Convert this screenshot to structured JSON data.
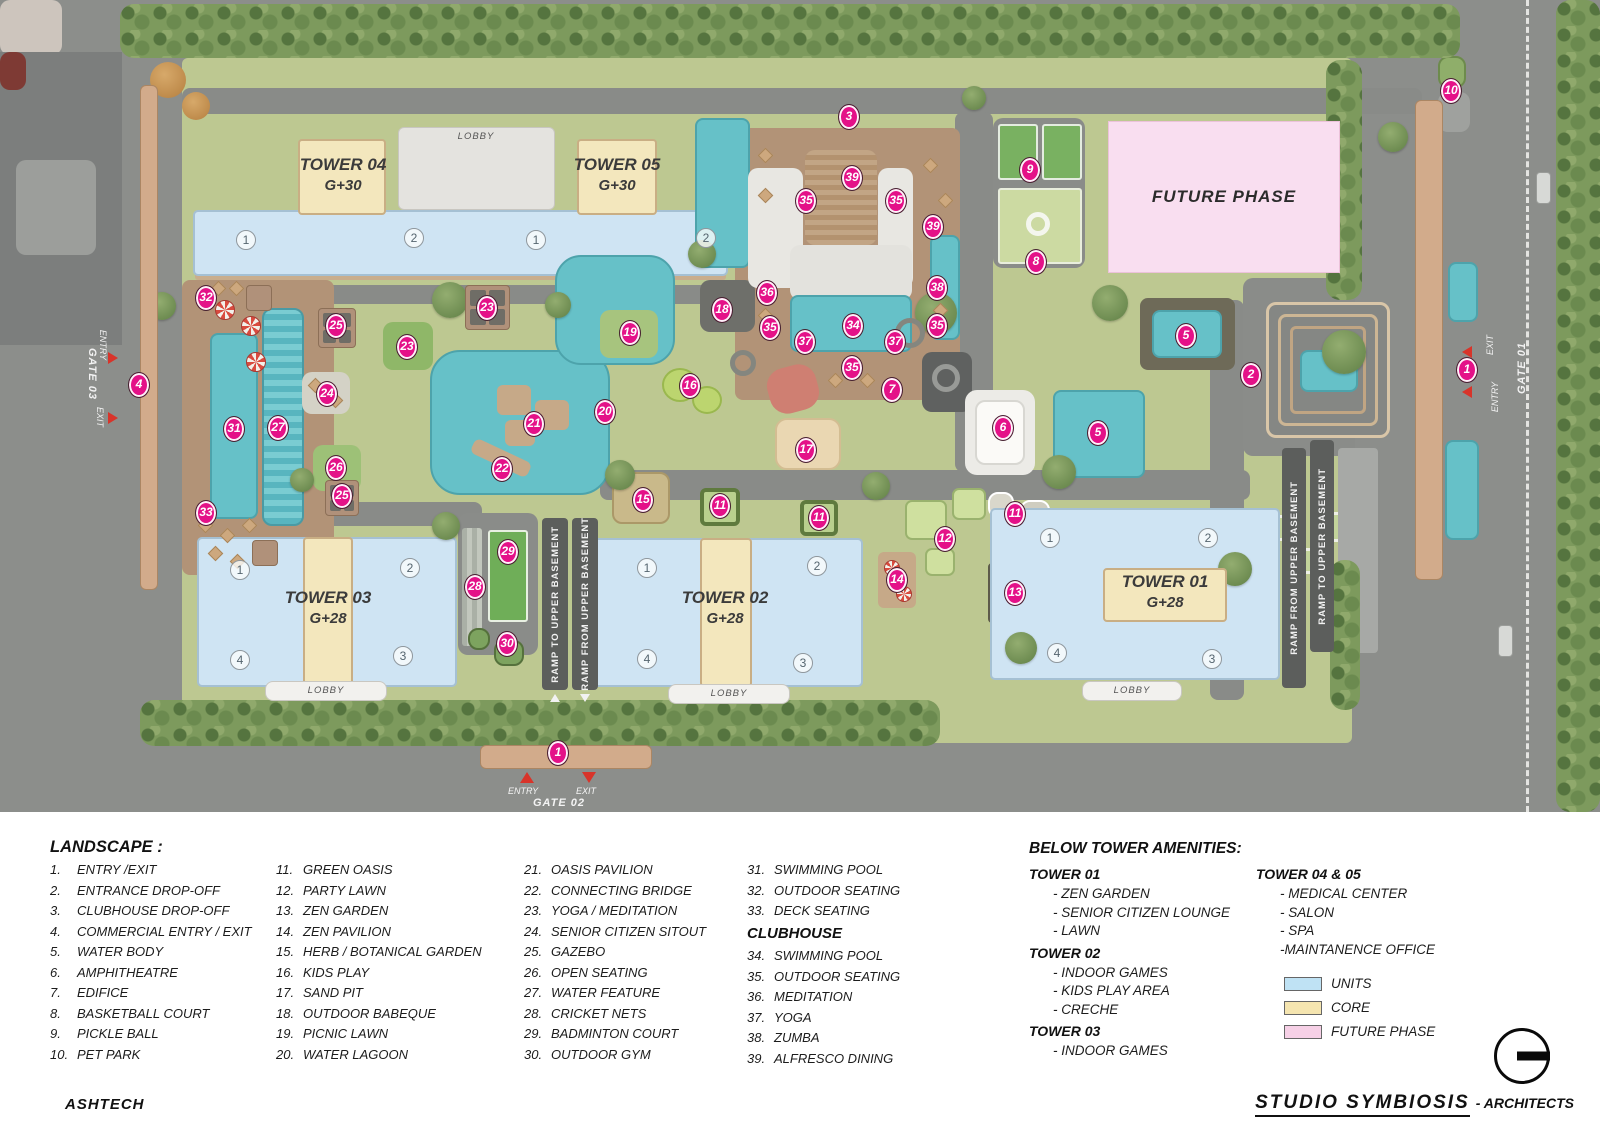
{
  "map": {
    "towers": {
      "t04": {
        "name": "TOWER 04",
        "floors": "G+30"
      },
      "t05": {
        "name": "TOWER 05",
        "floors": "G+30"
      },
      "t03": {
        "name": "TOWER 03",
        "floors": "G+28"
      },
      "t02": {
        "name": "TOWER 02",
        "floors": "G+28"
      },
      "t01": {
        "name": "TOWER 01",
        "floors": "G+28"
      }
    },
    "labels": {
      "lobby": "LOBBY",
      "future_phase": "FUTURE PHASE",
      "gate01": "GATE 01",
      "gate02": "GATE 02",
      "gate03": "GATE 03",
      "entry": "ENTRY",
      "exit": "EXIT",
      "ramp_to": "RAMP TO UPPER BASEMENT",
      "ramp_from": "RAMP FROM UPPER BASEMENT"
    },
    "markers": [
      [
        3,
        849,
        117
      ],
      [
        39,
        852,
        178
      ],
      [
        35,
        806,
        201
      ],
      [
        35,
        896,
        201
      ],
      [
        39,
        933,
        227
      ],
      [
        9,
        1030,
        170
      ],
      [
        8,
        1036,
        262
      ],
      [
        10,
        1451,
        91
      ],
      [
        36,
        767,
        293
      ],
      [
        38,
        937,
        288
      ],
      [
        18,
        722,
        310
      ],
      [
        19,
        630,
        333
      ],
      [
        23,
        487,
        308
      ],
      [
        23,
        407,
        347
      ],
      [
        25,
        336,
        326
      ],
      [
        32,
        206,
        298
      ],
      [
        34,
        853,
        326
      ],
      [
        35,
        770,
        328
      ],
      [
        35,
        937,
        326
      ],
      [
        37,
        805,
        342
      ],
      [
        37,
        895,
        342
      ],
      [
        35,
        852,
        368
      ],
      [
        5,
        1186,
        336
      ],
      [
        2,
        1251,
        375
      ],
      [
        16,
        690,
        386
      ],
      [
        24,
        327,
        394
      ],
      [
        31,
        234,
        429
      ],
      [
        27,
        278,
        428
      ],
      [
        21,
        534,
        424
      ],
      [
        20,
        605,
        412
      ],
      [
        7,
        892,
        390
      ],
      [
        6,
        1003,
        428
      ],
      [
        5,
        1098,
        433
      ],
      [
        17,
        806,
        450
      ],
      [
        26,
        336,
        468
      ],
      [
        22,
        502,
        469
      ],
      [
        15,
        643,
        500
      ],
      [
        11,
        720,
        506
      ],
      [
        11,
        819,
        518
      ],
      [
        11,
        1015,
        514
      ],
      [
        25,
        342,
        496
      ],
      [
        33,
        206,
        513
      ],
      [
        12,
        945,
        539
      ],
      [
        29,
        508,
        552
      ],
      [
        28,
        475,
        587
      ],
      [
        14,
        897,
        580
      ],
      [
        13,
        1015,
        593
      ],
      [
        30,
        507,
        644
      ],
      [
        1,
        558,
        753
      ],
      [
        1,
        1467,
        370
      ],
      [
        4,
        139,
        385
      ]
    ],
    "unit_numbers": [
      [
        1,
        246,
        240
      ],
      [
        2,
        414,
        238
      ],
      [
        1,
        536,
        240
      ],
      [
        2,
        706,
        238
      ],
      [
        1,
        240,
        570
      ],
      [
        2,
        410,
        568
      ],
      [
        4,
        240,
        660
      ],
      [
        3,
        403,
        656
      ],
      [
        1,
        647,
        568
      ],
      [
        2,
        817,
        566
      ],
      [
        4,
        647,
        659
      ],
      [
        3,
        803,
        663
      ],
      [
        1,
        1050,
        538
      ],
      [
        2,
        1208,
        538
      ],
      [
        4,
        1057,
        653
      ],
      [
        3,
        1212,
        659
      ]
    ]
  },
  "legend": {
    "landscape_title": "LANDSCAPE :",
    "landscape_items": [
      "ENTRY /EXIT",
      "ENTRANCE DROP-OFF",
      "CLUBHOUSE DROP-OFF",
      "COMMERCIAL ENTRY / EXIT",
      "WATER BODY",
      "AMPHITHEATRE",
      "EDIFICE",
      "BASKETBALL COURT",
      "PICKLE BALL",
      "PET PARK",
      "GREEN OASIS",
      "PARTY LAWN",
      "ZEN GARDEN",
      "ZEN PAVILION",
      "HERB / BOTANICAL GARDEN",
      "KIDS PLAY",
      "SAND PIT",
      "OUTDOOR BABEQUE",
      "PICNIC LAWN",
      "WATER LAGOON",
      "OASIS PAVILION",
      "CONNECTING BRIDGE",
      "YOGA / MEDITATION",
      "SENIOR CITIZEN SITOUT",
      "GAZEBO",
      "OPEN SEATING",
      "WATER FEATURE",
      "CRICKET NETS",
      "BADMINTON COURT",
      "OUTDOOR GYM",
      "SWIMMING POOL",
      "OUTDOOR SEATING",
      "DECK SEATING"
    ],
    "clubhouse_title": "CLUBHOUSE",
    "clubhouse_items": [
      "SWIMMING POOL",
      "OUTDOOR SEATING",
      "MEDITATION",
      "YOGA",
      "ZUMBA",
      "ALFRESCO DINING"
    ],
    "below_tower": {
      "title": "BELOW TOWER AMENITIES:",
      "groups": [
        {
          "name": "TOWER 01",
          "items": [
            "- ZEN GARDEN",
            "- SENIOR CITIZEN LOUNGE",
            "- LAWN"
          ]
        },
        {
          "name": "TOWER 02",
          "items": [
            "- INDOOR GAMES",
            "- KIDS PLAY AREA",
            "- CRECHE"
          ]
        },
        {
          "name": "TOWER 03",
          "items": [
            "- INDOOR GAMES"
          ]
        }
      ],
      "groups_right": [
        {
          "name": "TOWER 04 & 05",
          "items": [
            "- MEDICAL CENTER",
            "- SALON",
            "- SPA",
            "-MAINTANENCE OFFICE"
          ]
        }
      ]
    },
    "color_key": [
      {
        "label": "UNITS",
        "color": "#bfe2f4"
      },
      {
        "label": "CORE",
        "color": "#f5e5b0"
      },
      {
        "label": "FUTURE PHASE",
        "color": "#f6d0e6"
      }
    ]
  },
  "footer": {
    "left": "ASHTECH",
    "brand": "STUDIO SYMBIOSIS",
    "suffix": "- ARCHITECTS"
  },
  "colors": {
    "marker": "#e41188",
    "units": "#cfe4f3",
    "core": "#f3e7bd",
    "future_phase": "#f9def0",
    "water": "#66c1c8",
    "deck": "#b29377",
    "road": "#8c8e8b",
    "landscape": "#bdc891"
  }
}
